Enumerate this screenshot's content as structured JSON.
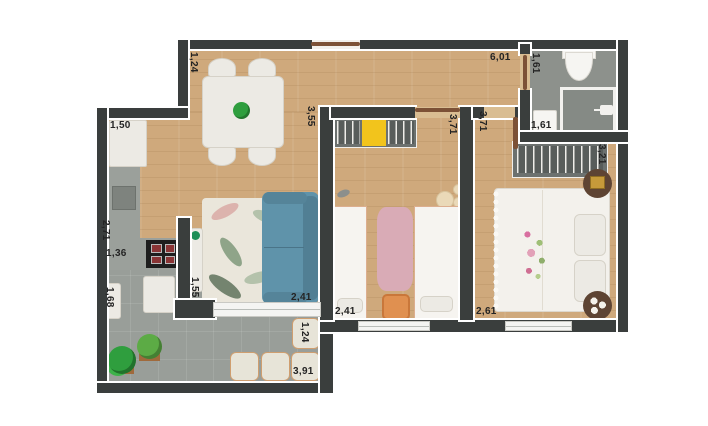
{
  "measurements": {
    "living_entry": "1,24",
    "kitchen_fridge": "1,50",
    "living_depth": "3,55",
    "living_width": "6,01",
    "bath_door": "1,61",
    "bath_width": "1,61",
    "bedroom2_depth": "3,71",
    "master_depth": "3,71",
    "master_wardrobe": "3,21",
    "kitchen_depth": "2,71",
    "kitchen_width": "1,36",
    "living_side": "1,55",
    "living_bottom": "2,41",
    "bedroom2_width": "2,41",
    "master_width": "2,61",
    "balcony_depth": "1,68",
    "balcony_side": "1,24",
    "balcony_width": "3,91"
  },
  "colors": {
    "wall": "#3a3e3d",
    "wood_floor": "#cfa97c",
    "tile_floor": "#999e99",
    "counter": "#9ba09b",
    "sofa": "#5f93aa",
    "wardrobe_accent_yellow": "#f2c41c",
    "rug_pink": "#d9abb6",
    "nightstand_orange": "#e09050",
    "plant_green": "#2f9e3e",
    "door_brown": "#7c5136",
    "label_text": "#242424"
  },
  "furniture": [
    "dining-table",
    "chairs",
    "fridge",
    "kitchen-counter",
    "stove",
    "sideboard",
    "sofa",
    "rug",
    "wardrobe",
    "single-beds",
    "pink-rug",
    "nightstand",
    "double-bed",
    "round-nightstands",
    "toilet",
    "shower",
    "bathroom-sink",
    "washer",
    "poufs",
    "plants",
    "sliding-door",
    "windows"
  ]
}
